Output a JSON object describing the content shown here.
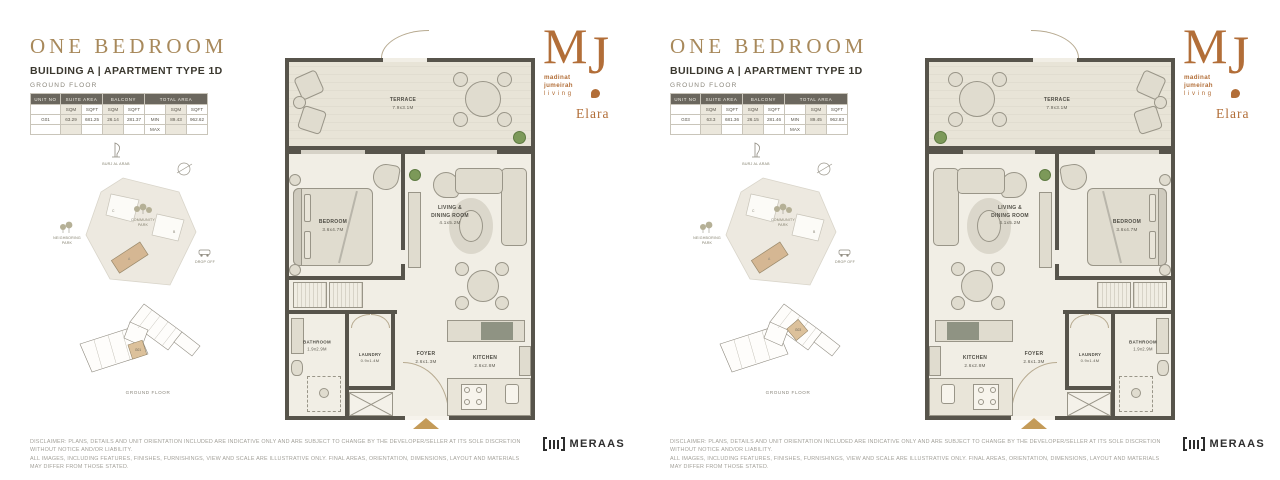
{
  "brand": {
    "monogram_m": "M",
    "monogram_j": "J",
    "wordmark_lines": [
      "madinat",
      "jumeirah",
      "living"
    ],
    "project_name": "Elara",
    "developer": "MERAAS"
  },
  "disclaimer_line1": "DISCLAIMER: PLANS, DETAILS AND UNIT ORIENTATION INCLUDED ARE INDICATIVE ONLY AND ARE SUBJECT TO CHANGE BY THE DEVELOPER/SELLER AT ITS SOLE DISCRETION WITHOUT NOTICE AND/OR LIABILITY.",
  "disclaimer_line2": "ALL IMAGES, INCLUDING FEATURES, FINISHES, FURNISHINGS, VIEW AND SCALE ARE ILLUSTRATIVE ONLY. FINAL AREAS, ORIENTATION, DIMENSIONS, LAYOUT AND MATERIALS MAY DIFFER FROM THOSE STATED.",
  "panels": [
    {
      "title": "ONE BEDROOM",
      "subtitle": "BUILDING A | APARTMENT TYPE 1D",
      "floor_label": "GROUND FLOOR",
      "area_table": {
        "col_unit": "UNIT NO",
        "col_suite": "SUITE AREA",
        "col_balcony": "BALCONY",
        "col_total": "TOTAL AREA",
        "sub_sqm1": "SQM",
        "sub_sqft1": "SQFT",
        "sub_sqm2": "SQM",
        "sub_sqft2": "SQFT",
        "sub_sqm3": "SQM",
        "sub_sqft3": "SQFT",
        "unit_no": "G01",
        "suite_sqm": "63.29",
        "suite_sqft": "681.25",
        "balcony_sqm": "26.14",
        "balcony_sqft": "281.37",
        "min_label": "MIN",
        "max_label": "MAX",
        "total_sqm": "89.43",
        "total_sqft": "962.62"
      },
      "site_map": {
        "landmark": "BURJ AL ARAB",
        "park_line1": "COMMUNITY",
        "park_line2": "PARK",
        "neighboring_line1": "NEIGHBORING",
        "neighboring_line2": "PARK",
        "drop_off": "DROP OFF",
        "building_a": "A",
        "building_b": "B",
        "building_c": "C"
      },
      "key_plan": {
        "unit": "G01",
        "caption": "GROUND FLOOR"
      },
      "rooms": {
        "terrace": "TERRACE",
        "terrace_dims": "7.9x3.1M",
        "bedroom": "BEDROOM",
        "bedroom_dims": "3.6x4.7M",
        "living_line1": "LIVING &",
        "living_line2": "DINING ROOM",
        "living_dims": "4.1x5.2M",
        "bathroom": "BATHROOM",
        "bathroom_dims": "1.9x2.9M",
        "laundry": "LAUNDRY",
        "laundry_dims": "0.9x1.4M",
        "foyer": "FOYER",
        "foyer_dims": "2.6x1.3M",
        "kitchen": "KITCHEN",
        "kitchen_dims": "2.6x2.8M"
      }
    },
    {
      "title": "ONE BEDROOM",
      "subtitle": "BUILDING A | APARTMENT TYPE 1D",
      "floor_label": "GROUND FLOOR",
      "area_table": {
        "col_unit": "UNIT NO",
        "col_suite": "SUITE AREA",
        "col_balcony": "BALCONY",
        "col_total": "TOTAL AREA",
        "sub_sqm1": "SQM",
        "sub_sqft1": "SQFT",
        "sub_sqm2": "SQM",
        "sub_sqft2": "SQFT",
        "sub_sqm3": "SQM",
        "sub_sqft3": "SQFT",
        "unit_no": "G03",
        "suite_sqm": "63.3",
        "suite_sqft": "681.36",
        "balcony_sqm": "26.15",
        "balcony_sqft": "281.46",
        "min_label": "MIN",
        "max_label": "MAX",
        "total_sqm": "89.45",
        "total_sqft": "962.83"
      },
      "site_map": {
        "landmark": "BURJ AL ARAB",
        "park_line1": "COMMUNITY",
        "park_line2": "PARK",
        "neighboring_line1": "NEIGHBORING",
        "neighboring_line2": "PARK",
        "drop_off": "DROP OFF",
        "building_a": "A",
        "building_b": "B",
        "building_c": "C"
      },
      "key_plan": {
        "unit": "G03",
        "caption": "GROUND FLOOR"
      },
      "rooms": {
        "terrace": "TERRACE",
        "terrace_dims": "7.9x3.1M",
        "bedroom": "BEDROOM",
        "bedroom_dims": "3.6x4.7M",
        "living_line1": "LIVING &",
        "living_line2": "DINING ROOM",
        "living_dims": "4.1x5.2M",
        "bathroom": "BATHROOM",
        "bathroom_dims": "1.9x2.9M",
        "laundry": "LAUNDRY",
        "laundry_dims": "0.9x1.4M",
        "foyer": "FOYER",
        "foyer_dims": "2.6x1.3M",
        "kitchen": "KITCHEN",
        "kitchen_dims": "2.6x2.8M"
      }
    }
  ],
  "colors": {
    "title_gold": "#A8895B",
    "copper": "#B26E38",
    "wall": "#57544B",
    "floor": "#F1EEE5",
    "highlight_tan": "#D5B793",
    "table_header": "#6B675E"
  }
}
